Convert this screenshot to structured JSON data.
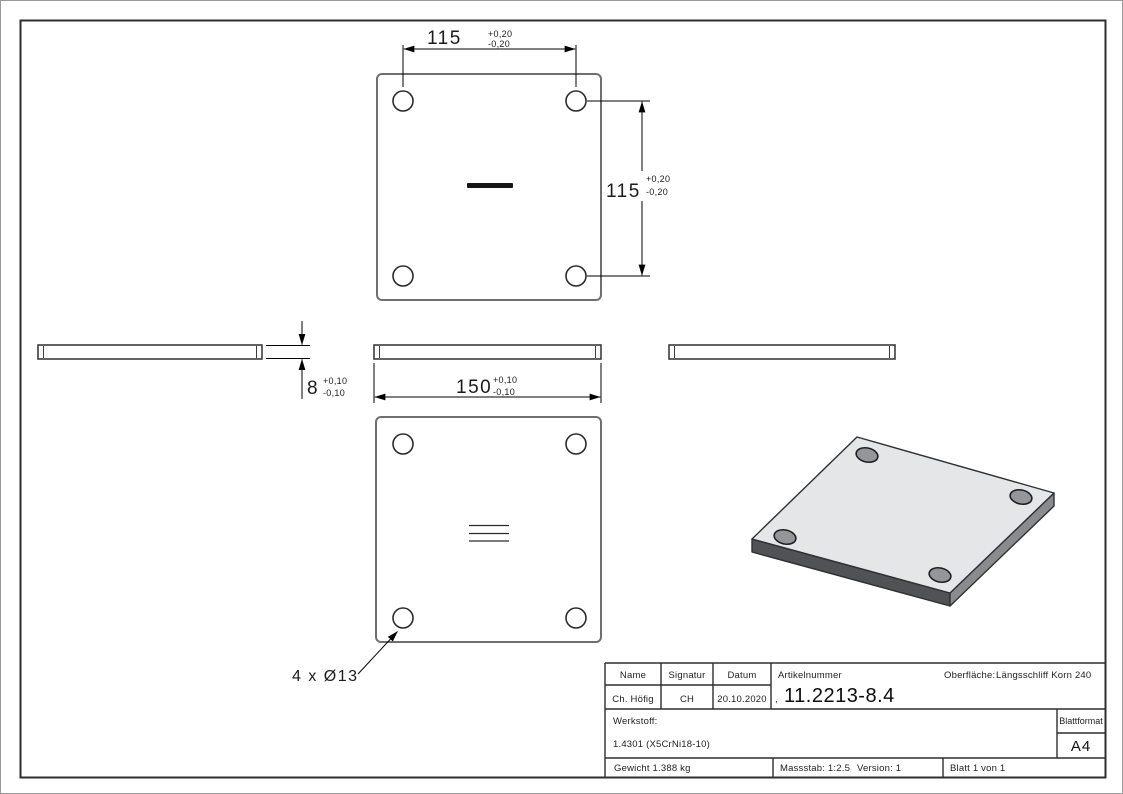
{
  "document": {
    "type": "technical-drawing",
    "part": "square mounting plate with 4 holes"
  },
  "colors": {
    "frame": "#2e2e2e",
    "view_outline": "#6f6f6f",
    "edge_line": "#3d3d3d",
    "dim_line": "#000000",
    "plate_top": "#e5e6e7",
    "plate_side_left": "#515256",
    "plate_side_right": "#8a8b8e",
    "hole_fill": "#95969a"
  },
  "dims": {
    "top_width": {
      "value": "115",
      "plus": "+0,20",
      "minus": "-0,20"
    },
    "right_height": {
      "value": "115",
      "plus": "+0,20",
      "minus": "-0,20"
    },
    "thickness": {
      "value": "8",
      "plus": "+0,10",
      "minus": "-0,10"
    },
    "side_width": {
      "value": "150",
      "plus": "+0,10",
      "minus": "-0,10"
    },
    "holes_label": "4 x Ø13"
  },
  "title_block": {
    "name_label": "Name",
    "signatur_label": "Signatur",
    "datum_label": "Datum",
    "artikelnummer_label": "Artikelnummer",
    "oberflaeche_label": "Oberfläche:",
    "oberflaeche_value": "Längsschliff Korn 240",
    "name_value": "Ch. Höfig",
    "signatur_value": "CH",
    "datum_value": "20.10.2020",
    "artikelnummer_prefix": ",",
    "artikelnummer_value": "11.2213-8.4",
    "werkstoff_label": "Werkstoff:",
    "werkstoff_value": "1.4301 (X5CrNi18-10)",
    "blattformat_label": "Blattformat",
    "blattformat_value": "A4",
    "gewicht": "Gewicht 1.388 kg",
    "massstab": "Massstab: 1:2.5",
    "version": "Version: 1",
    "blatt": "Blatt 1 von 1"
  }
}
